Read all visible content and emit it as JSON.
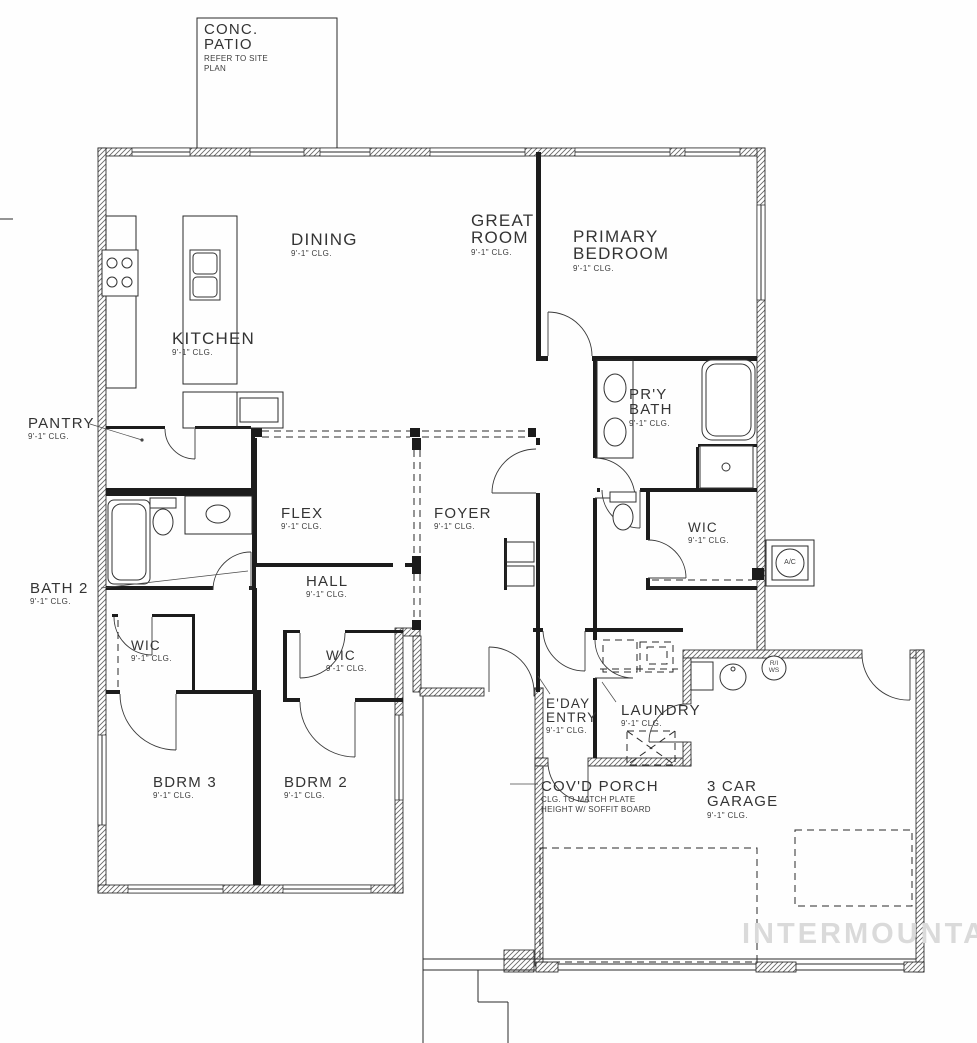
{
  "plan": {
    "watermark": "INTERMOUNTAIN"
  },
  "rooms": {
    "conc_patio": {
      "name": "CONC.\nPATIO",
      "note": "REFER TO SITE\nPLAN"
    },
    "dining": {
      "name": "DINING",
      "clg": "9'-1\" CLG."
    },
    "great_room": {
      "name": "GREAT\nROOM",
      "clg": "9'-1\" CLG."
    },
    "primary_bedroom": {
      "name": "PRIMARY\nBEDROOM",
      "clg": "9'-1\" CLG."
    },
    "kitchen": {
      "name": "KITCHEN",
      "clg": "9'-1\" CLG."
    },
    "pantry": {
      "name": "PANTRY",
      "clg": "9'-1\" CLG."
    },
    "pry_bath": {
      "name": "PR'Y\nBATH",
      "clg": "9'-1\" CLG."
    },
    "flex": {
      "name": "FLEX",
      "clg": "9'-1\" CLG."
    },
    "foyer": {
      "name": "FOYER",
      "clg": "9'-1\" CLG."
    },
    "wic_primary": {
      "name": "WIC",
      "clg": "9'-1\" CLG."
    },
    "bath_2": {
      "name": "BATH 2",
      "clg": "9'-1\" CLG."
    },
    "hall": {
      "name": "HALL",
      "clg": "9'-1\" CLG."
    },
    "wic_bdrm3": {
      "name": "WIC",
      "clg": "9'-1\" CLG."
    },
    "wic_bdrm2": {
      "name": "WIC",
      "clg": "9'-1\" CLG."
    },
    "eday_entry": {
      "name": "E'DAY\nENTRY",
      "clg": "9'-1\" CLG."
    },
    "laundry": {
      "name": "LAUNDRY",
      "clg": "9'-1\" CLG."
    },
    "covd_porch": {
      "name": "COV'D PORCH",
      "note": "CLG. TO MATCH PLATE\nHEIGHT W/ SOFFIT BOARD"
    },
    "bdrm_3": {
      "name": "BDRM 3",
      "clg": "9'-1\" CLG."
    },
    "bdrm_2": {
      "name": "BDRM 2",
      "clg": "9'-1\" CLG."
    },
    "garage": {
      "name": "3 CAR\nGARAGE",
      "clg": "9'-1\" CLG."
    }
  },
  "equipment": {
    "ac_unit": "A/C",
    "water_softener": "R/I\nWS"
  }
}
